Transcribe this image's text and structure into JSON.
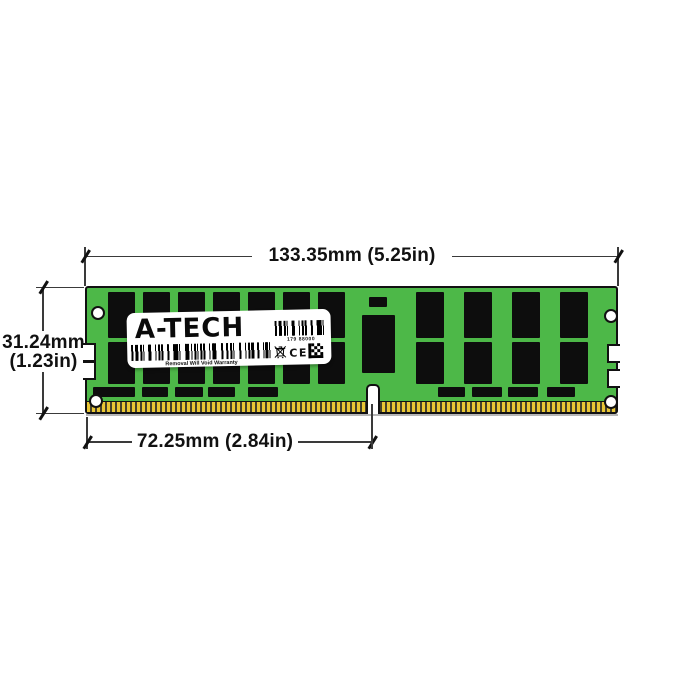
{
  "dimension_annotations": {
    "module_width": "133.35mm (5.25in)",
    "module_height_mm": "31.24mm",
    "module_height_in": "(1.23in)",
    "contact_edge_width": "72.25mm (2.84in)"
  },
  "label": {
    "brand": "A-TECH",
    "serial_number": "179 88000",
    "warranty_text": "Removal Will Void Warranty",
    "ce_mark": "CE"
  },
  "colors": {
    "pcb_green": "#4db848",
    "chip_black": "#0d0d0d",
    "pin_gold": "#e9c634",
    "dimension_line": "#3a3a3a",
    "label_white": "#ffffff"
  }
}
